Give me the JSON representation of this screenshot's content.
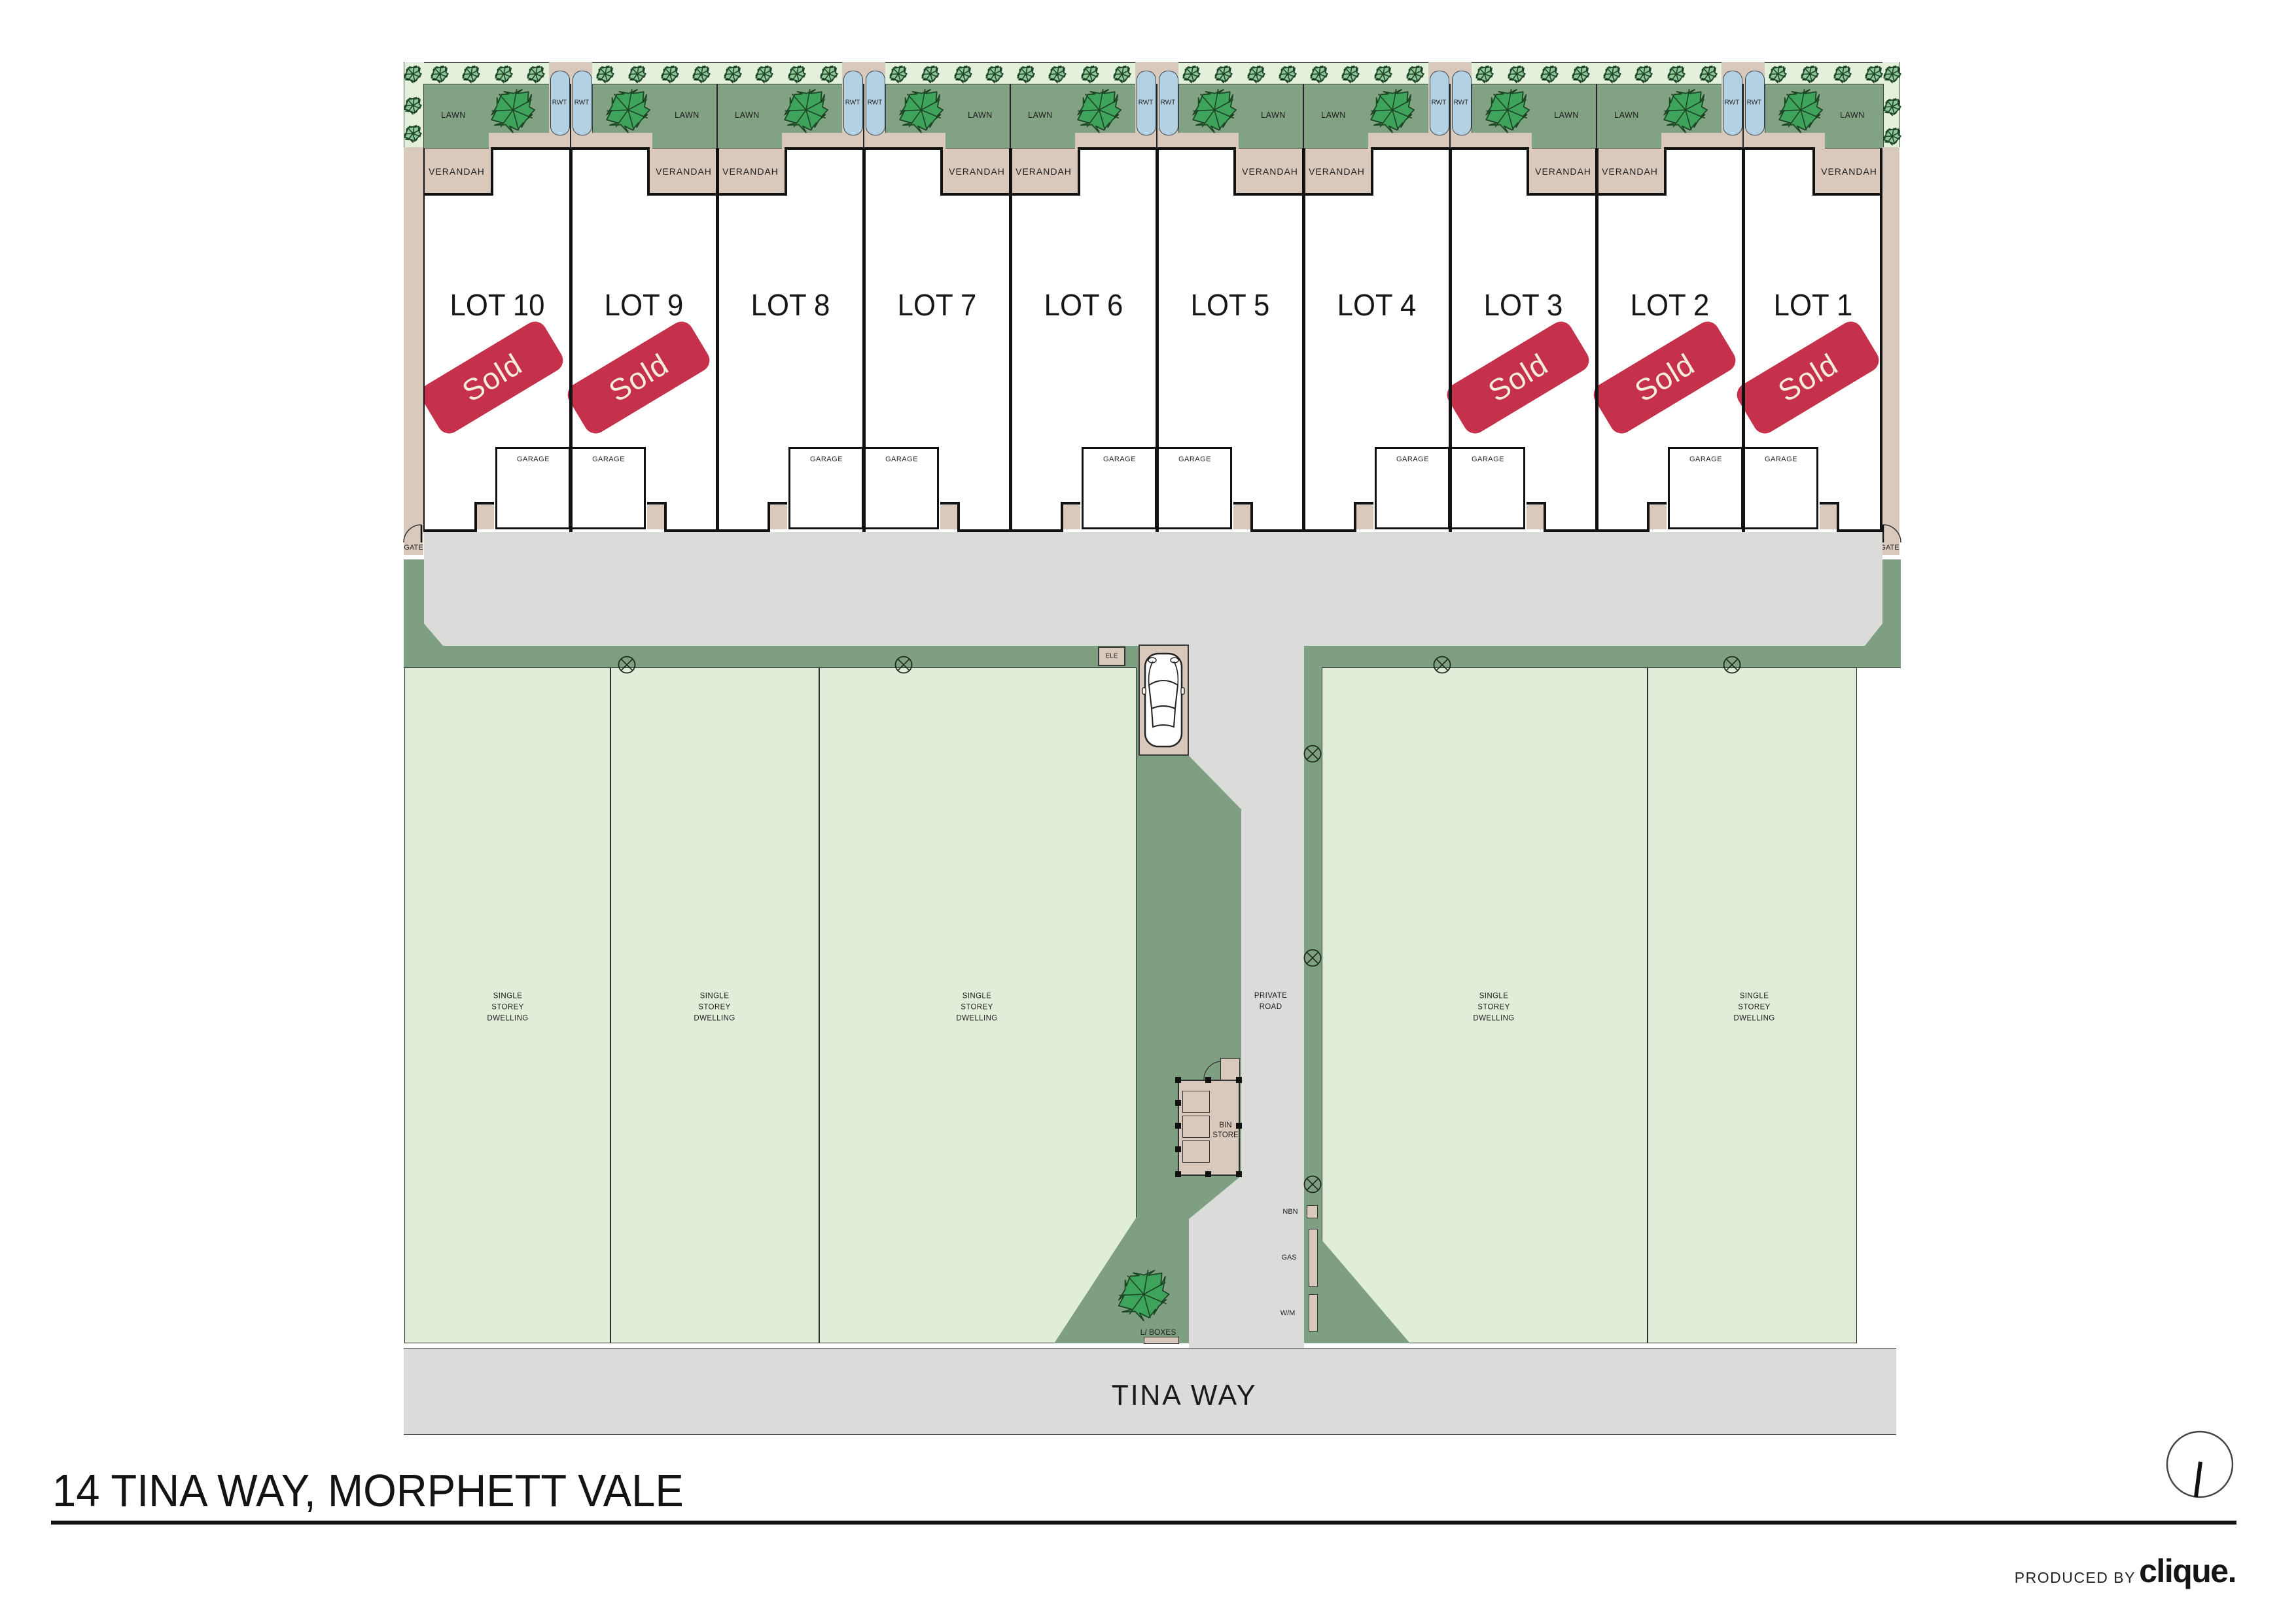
{
  "page": {
    "title": "14 TINA WAY, MORPHETT VALE"
  },
  "street": {
    "name": "TINA WAY"
  },
  "footer": {
    "produced_by": "PRODUCED BY",
    "brand": "clique."
  },
  "plan": {
    "colors": {
      "light_green": "#E3F0DC",
      "block_green": "#DFEDD9",
      "lawn_green": "#81A384",
      "verge_green": "#7E9F81",
      "tree_fill": "#3FA45B",
      "tree_small_fill": "#90C89C",
      "tree_stroke": "#1E4426",
      "tank_blue": "#B5D2E5",
      "beige": "#D9C9BD",
      "road_grey": "#DBDCD9",
      "wall_black": "#111111",
      "sold_red": "#C5304A",
      "sold_text": "#F5EDDC"
    },
    "labels": {
      "lawn": "LAWN",
      "verandah": "VERANDAH",
      "garage": "GARAGE",
      "rwt": "RWT",
      "gate": "GATE",
      "ele": "ELE",
      "bin_store_lines": [
        "BIN",
        "STORE"
      ],
      "letter_boxes": "L/ BOXES",
      "private_road_lines": [
        "PRIVATE",
        "ROAD"
      ],
      "nbn": "NBN",
      "gas": "GAS",
      "wm": "W/M",
      "dwelling_lines": [
        "SINGLE",
        "STOREY",
        "DWELLING"
      ]
    },
    "sold_label": "Sold",
    "lots": [
      {
        "name": "LOT 10",
        "sold": true
      },
      {
        "name": "LOT 9",
        "sold": true
      },
      {
        "name": "LOT 8",
        "sold": false
      },
      {
        "name": "LOT 7",
        "sold": false
      },
      {
        "name": "LOT 6",
        "sold": false
      },
      {
        "name": "LOT 5",
        "sold": false
      },
      {
        "name": "LOT 4",
        "sold": false
      },
      {
        "name": "LOT 3",
        "sold": true
      },
      {
        "name": "LOT 2",
        "sold": true
      },
      {
        "name": "LOT 1",
        "sold": true
      }
    ],
    "neighbour_dwelling_count": 5
  }
}
